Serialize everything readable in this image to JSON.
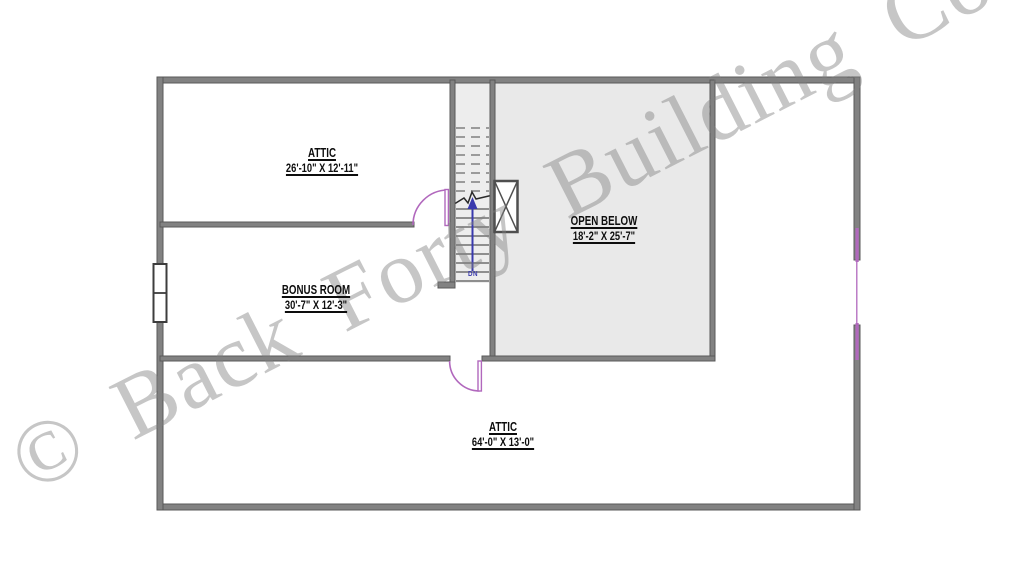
{
  "plan": {
    "watermark": "© Back Forty Building Co",
    "rooms": [
      {
        "name": "ATTIC",
        "dims": "26'-10\" X 12'-11\""
      },
      {
        "name": "BONUS ROOM",
        "dims": "30'-7\" X 12'-3\""
      },
      {
        "name": "OPEN BELOW",
        "dims": "18'-2\" X 25'-7\""
      },
      {
        "name": "ATTIC",
        "dims": "64'-0\" X 13'-0\""
      }
    ],
    "stairs": {
      "direction_label": "DN"
    },
    "colors": {
      "wall": "#828282",
      "wall_edge": "#595959",
      "area_fill": "#e9e9e9",
      "stair_fill": "#ededed",
      "tread": "#969696",
      "door": "#b168bd",
      "arrow": "#3939ad",
      "watermark": "rgba(128,128,128,0.45)",
      "label_text": "#0d0d0d"
    }
  }
}
